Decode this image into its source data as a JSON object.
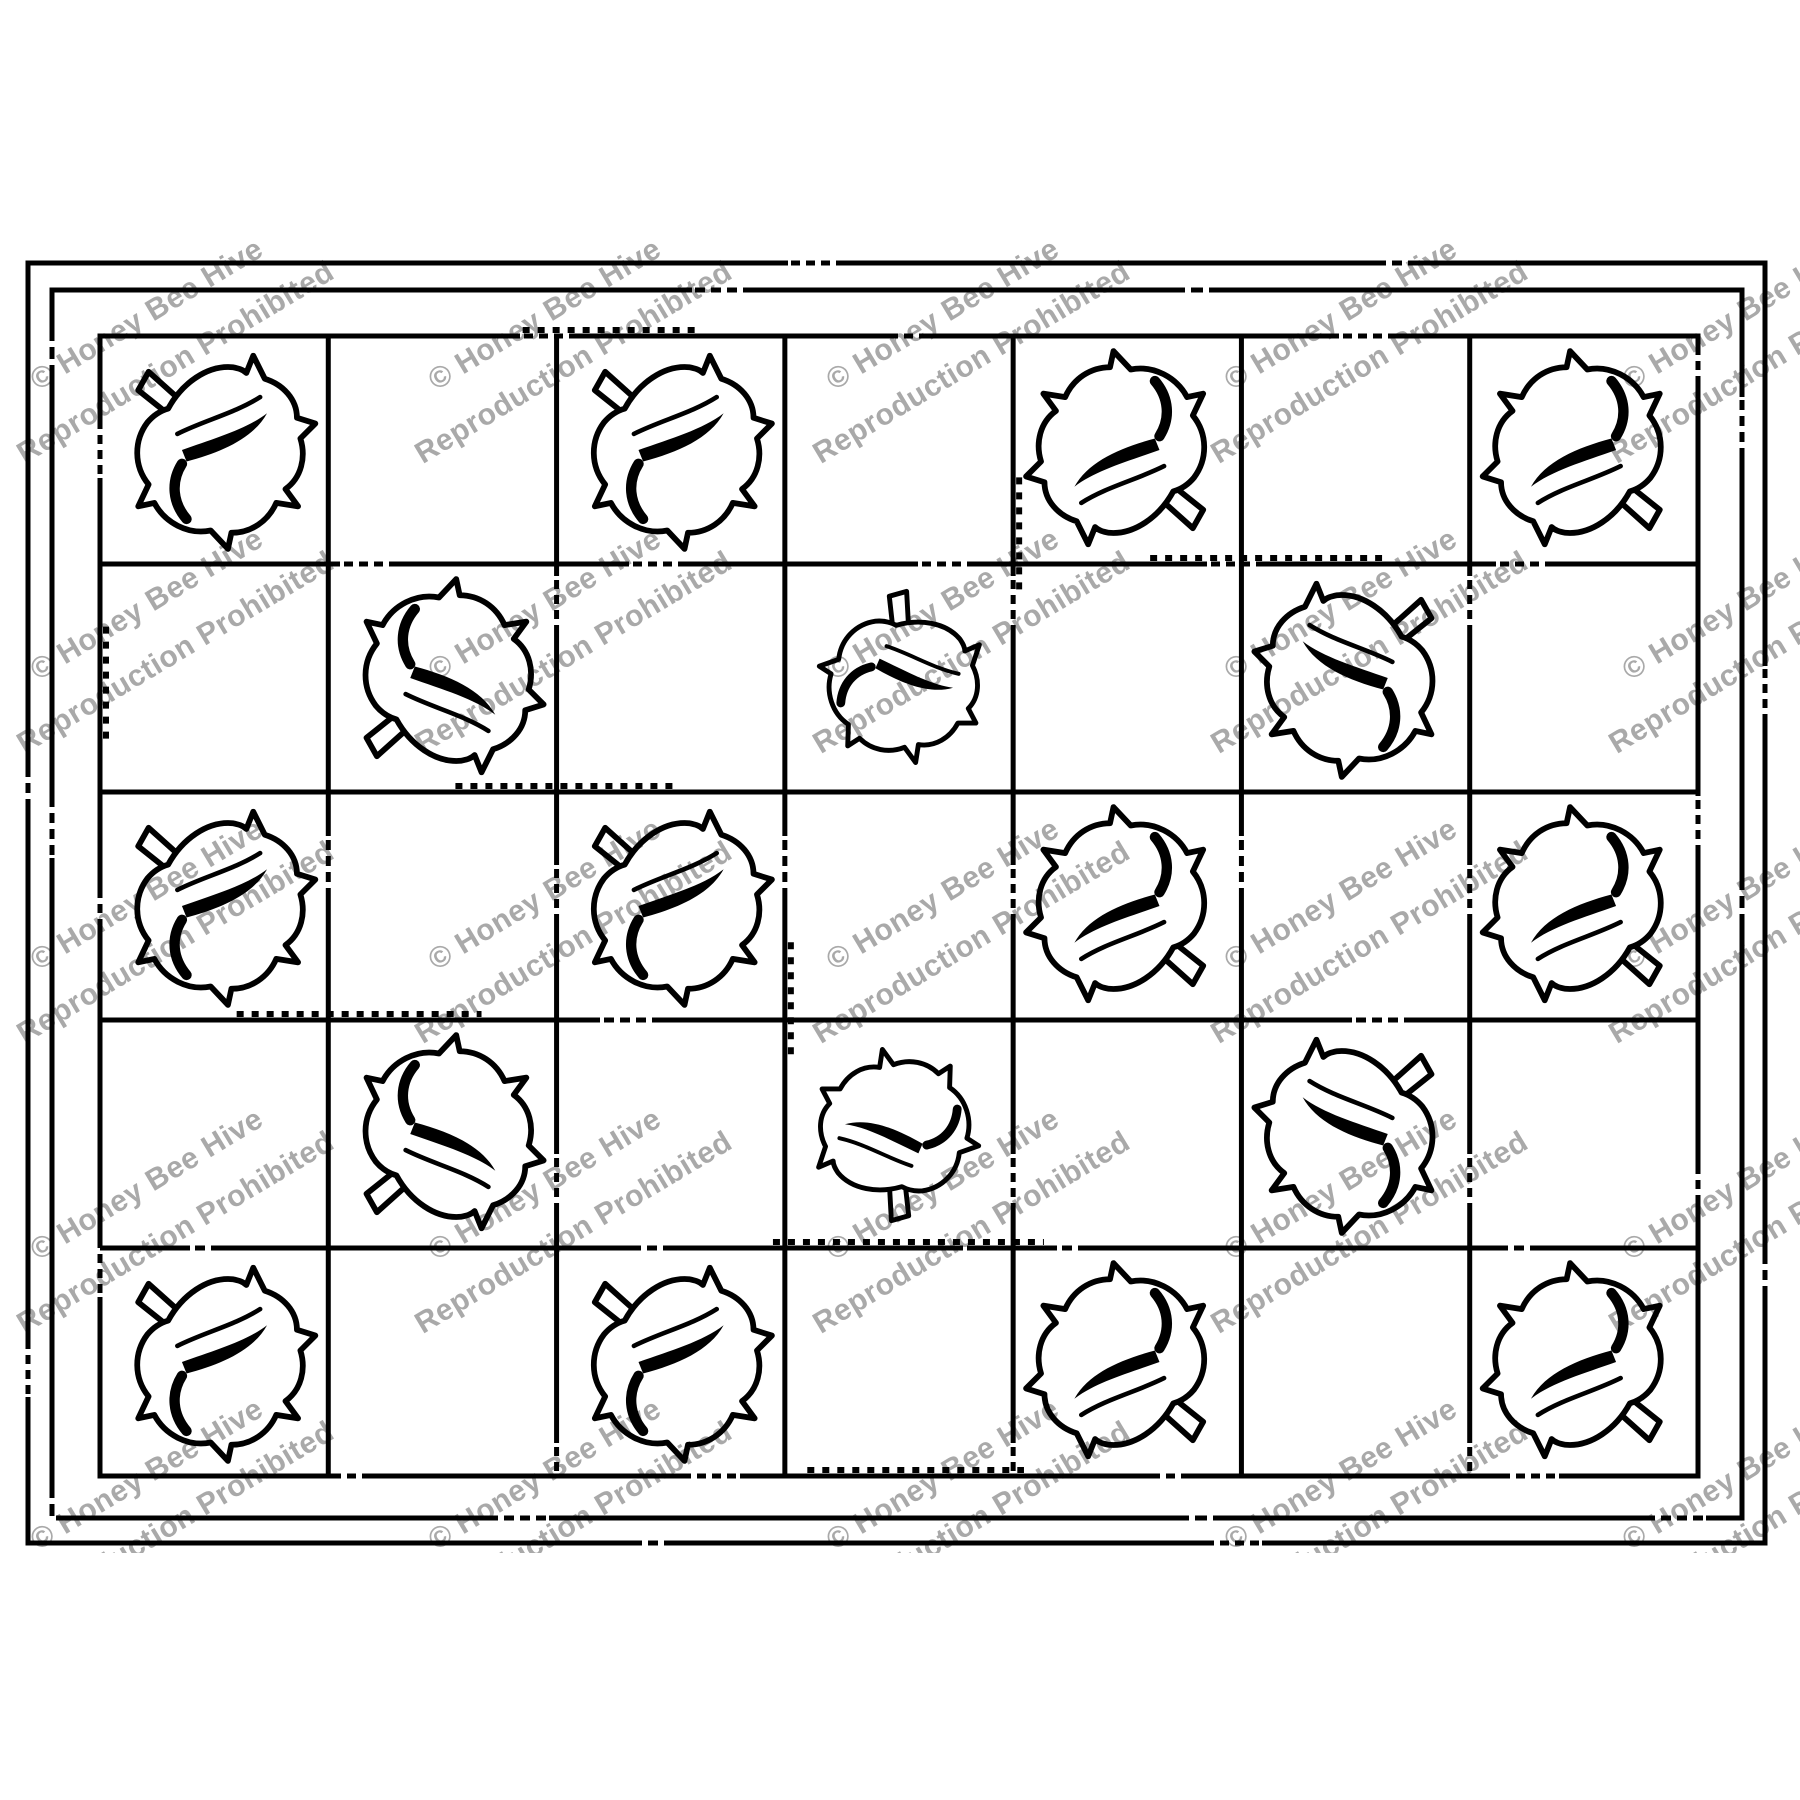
{
  "artwork": {
    "background": "#ffffff",
    "ink": "#000000",
    "line_width": 5,
    "watermark": {
      "line1": "© Honey Bee Hive",
      "line2": "Reproduction Prohibited",
      "color": "#a9a9a9",
      "rotation_deg": -31,
      "font_size": 30,
      "line_gap": 56,
      "col_x": [
        165,
        563,
        961,
        1359,
        1757
      ],
      "row_y": [
        345,
        635,
        925,
        1215,
        1505
      ],
      "clip": {
        "x": 0,
        "y": 235,
        "width": 1800,
        "height": 1318
      }
    },
    "borders": [
      {
        "name": "outer-border",
        "x": 28,
        "y": 263,
        "width": 1737,
        "height": 1280
      },
      {
        "name": "inner-border",
        "x": 52,
        "y": 290,
        "width": 1690,
        "height": 1228
      }
    ],
    "grid": {
      "x": 100,
      "y": 336,
      "width": 1598,
      "height": 1140,
      "cols": 7,
      "rows": 5
    },
    "leaves": [
      {
        "row": 0,
        "col": 0,
        "variant": "stem-up-left"
      },
      {
        "row": 0,
        "col": 2,
        "variant": "stem-up-left"
      },
      {
        "row": 0,
        "col": 4,
        "variant": "stem-down-right"
      },
      {
        "row": 0,
        "col": 6,
        "variant": "stem-down-right"
      },
      {
        "row": 1,
        "col": 1,
        "variant": "stem-down-left"
      },
      {
        "row": 1,
        "col": 3,
        "variant": "stem-up"
      },
      {
        "row": 1,
        "col": 5,
        "variant": "stem-up-right"
      },
      {
        "row": 2,
        "col": 0,
        "variant": "stem-up-left"
      },
      {
        "row": 2,
        "col": 2,
        "variant": "stem-up-left"
      },
      {
        "row": 2,
        "col": 4,
        "variant": "stem-down-right"
      },
      {
        "row": 2,
        "col": 6,
        "variant": "stem-down-right"
      },
      {
        "row": 3,
        "col": 1,
        "variant": "stem-down-left"
      },
      {
        "row": 3,
        "col": 3,
        "variant": "stem-down"
      },
      {
        "row": 3,
        "col": 5,
        "variant": "stem-up-right"
      },
      {
        "row": 4,
        "col": 0,
        "variant": "stem-up-left"
      },
      {
        "row": 4,
        "col": 2,
        "variant": "stem-up-left"
      },
      {
        "row": 4,
        "col": 4,
        "variant": "stem-down-right"
      },
      {
        "row": 4,
        "col": 6,
        "variant": "stem-down-right"
      }
    ]
  }
}
